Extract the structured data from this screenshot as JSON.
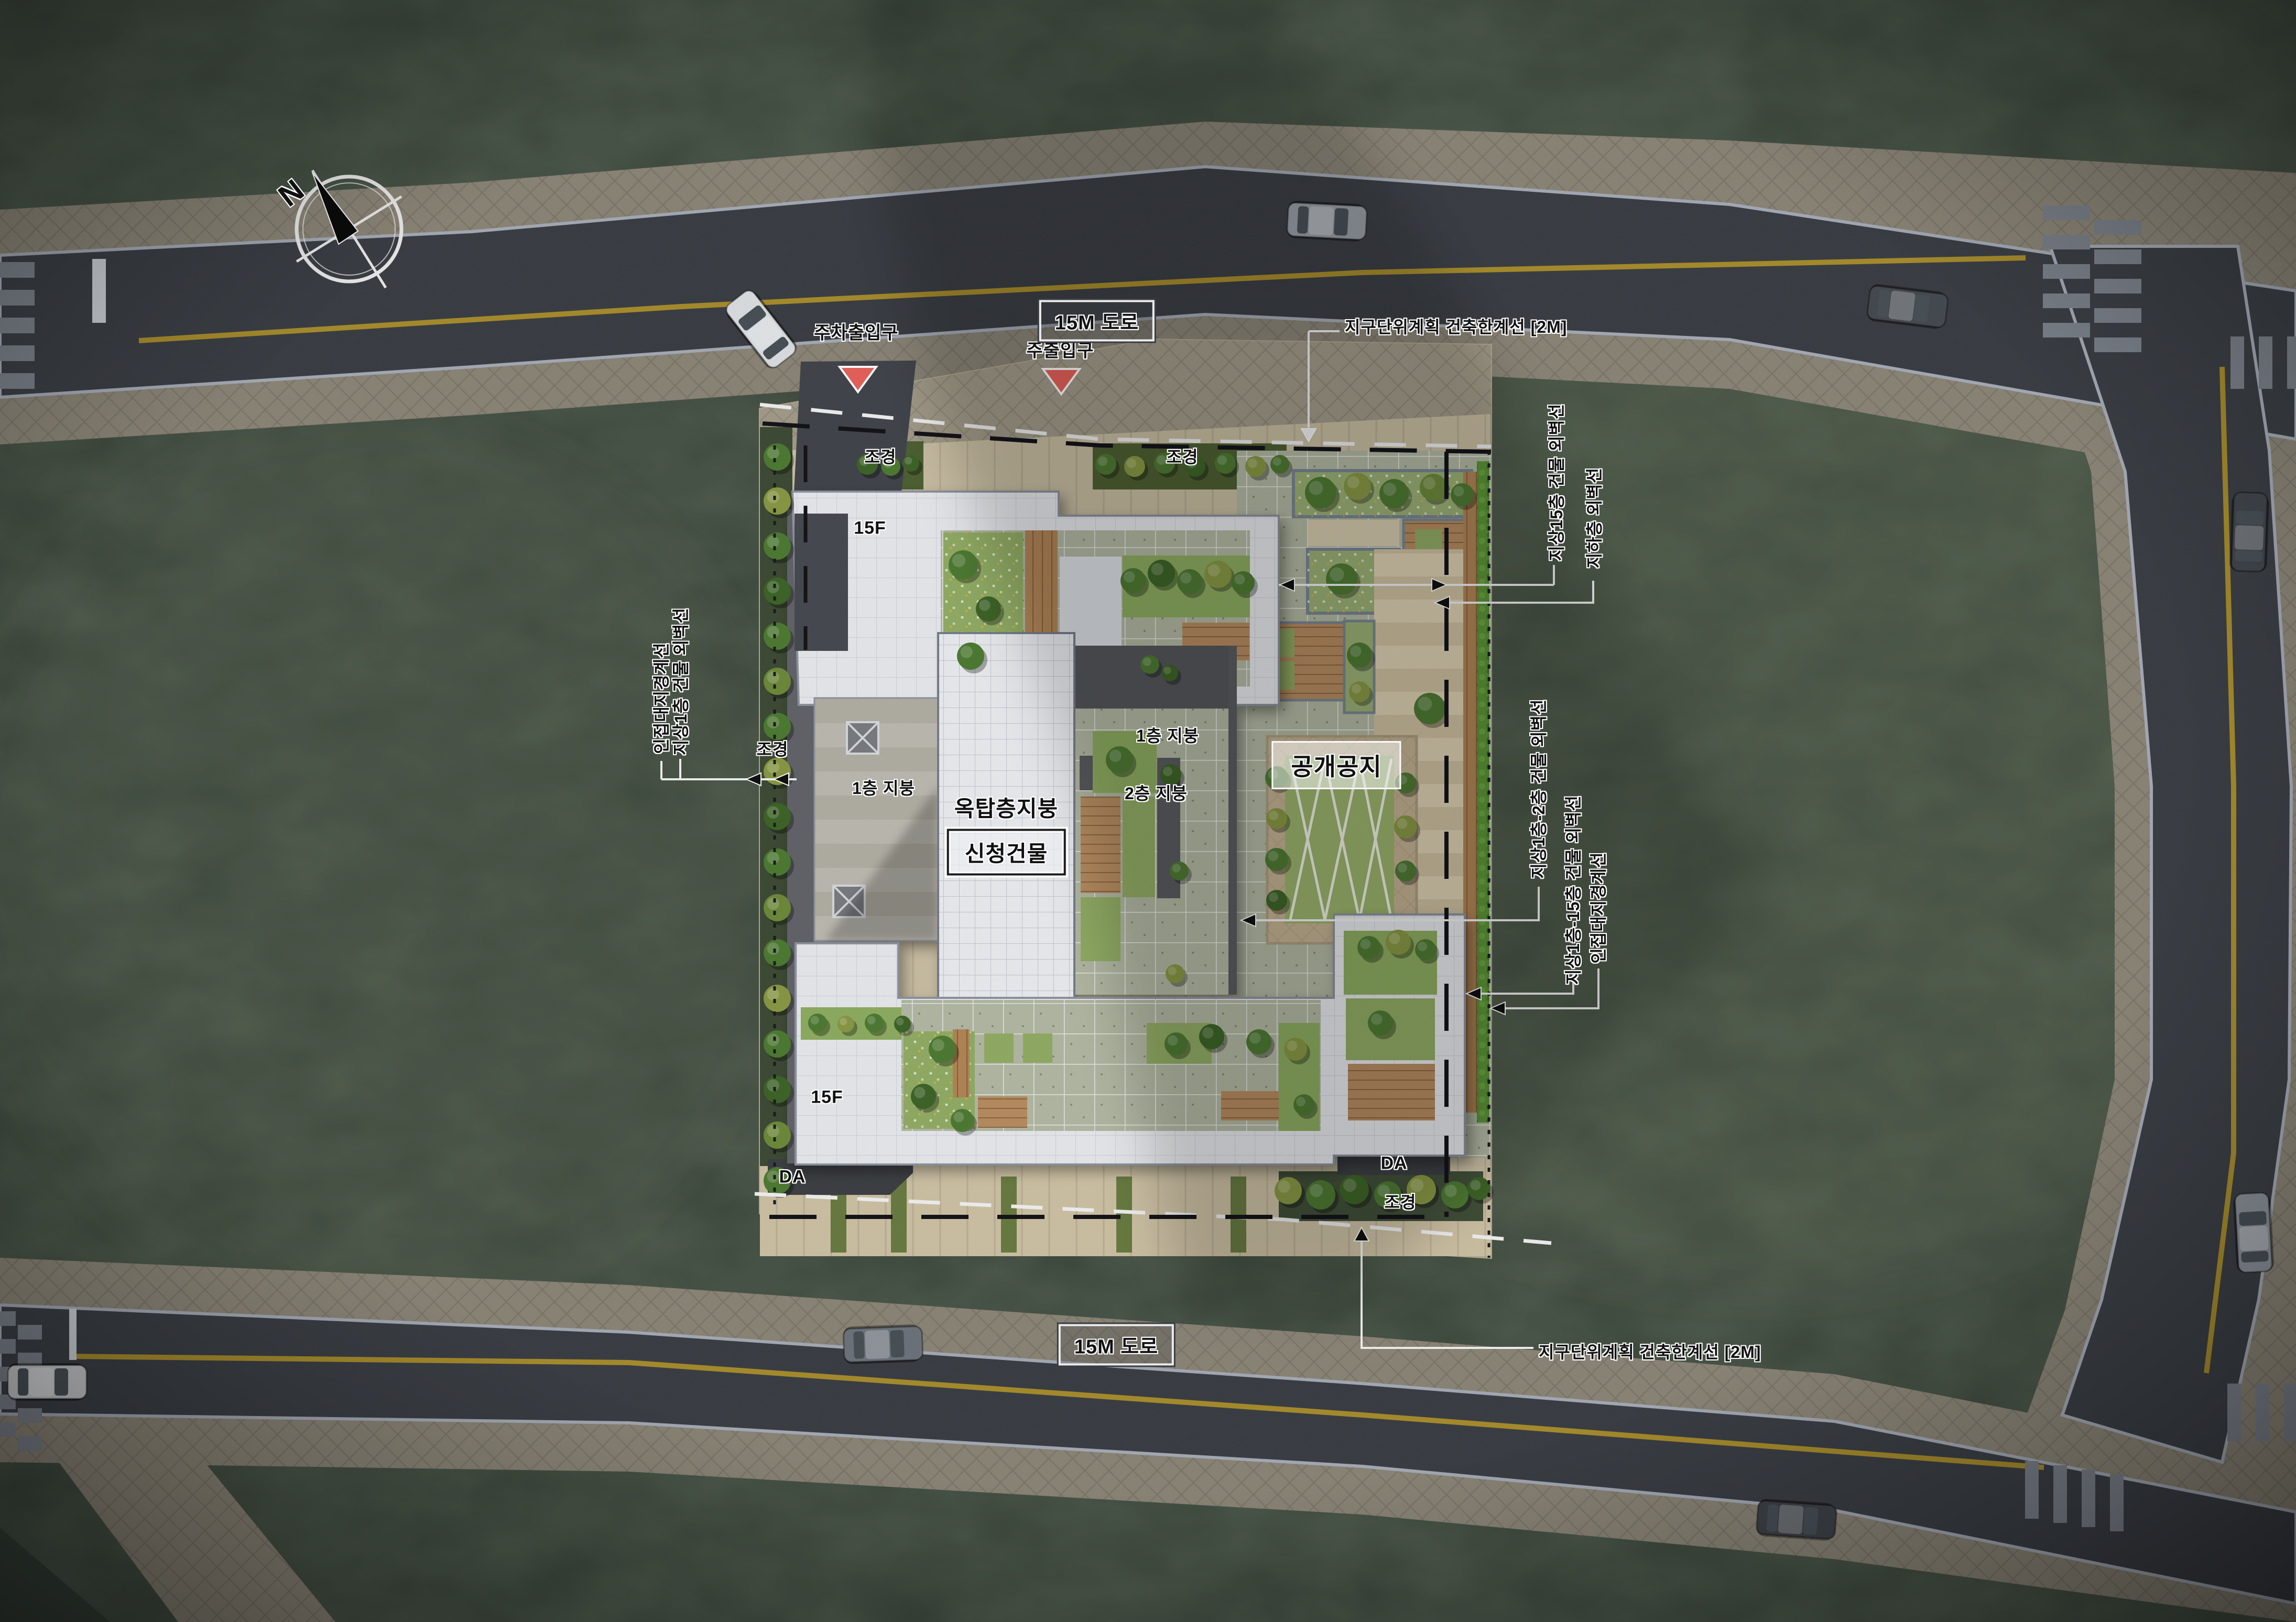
{
  "map": {
    "north": "N",
    "road_label": "15M 도로",
    "entrances": {
      "parking": "주차출입구",
      "main": "주출입구"
    },
    "annotations": {
      "limit_line": "지구단위계획 건축한계선 [2M]",
      "wall_15f": "지상15층 건물 외벽선",
      "wall_basement": "지하층 외벽선",
      "wall_f1_f2": "지상1층-2층 건물 외벽선",
      "wall_f1_f15": "지상1층-15층 건물 외벽선",
      "lot_boundary": "인접대지경계선",
      "wall_f1": "지상1층 건물 외벽선"
    },
    "site": {
      "public_open_space": "공개공지",
      "rooftop_floor_roof": "옥탑층지붕",
      "applied_building": "신청건물",
      "roof_1f": "1층 지붕",
      "roof_2f": "2층 지붕",
      "floors": "15F",
      "driveway": "DA",
      "landscaping": "조경"
    },
    "colors": {
      "road": "#3c4046",
      "sidewalk": "#8d8779",
      "grass": "#39443a",
      "roof_white": "#e9ebee",
      "lawn": "#93ae66",
      "wood_deck": "#b98e62",
      "entrance_marker": "#e8635c",
      "lane_line": "#a98e2e"
    }
  }
}
